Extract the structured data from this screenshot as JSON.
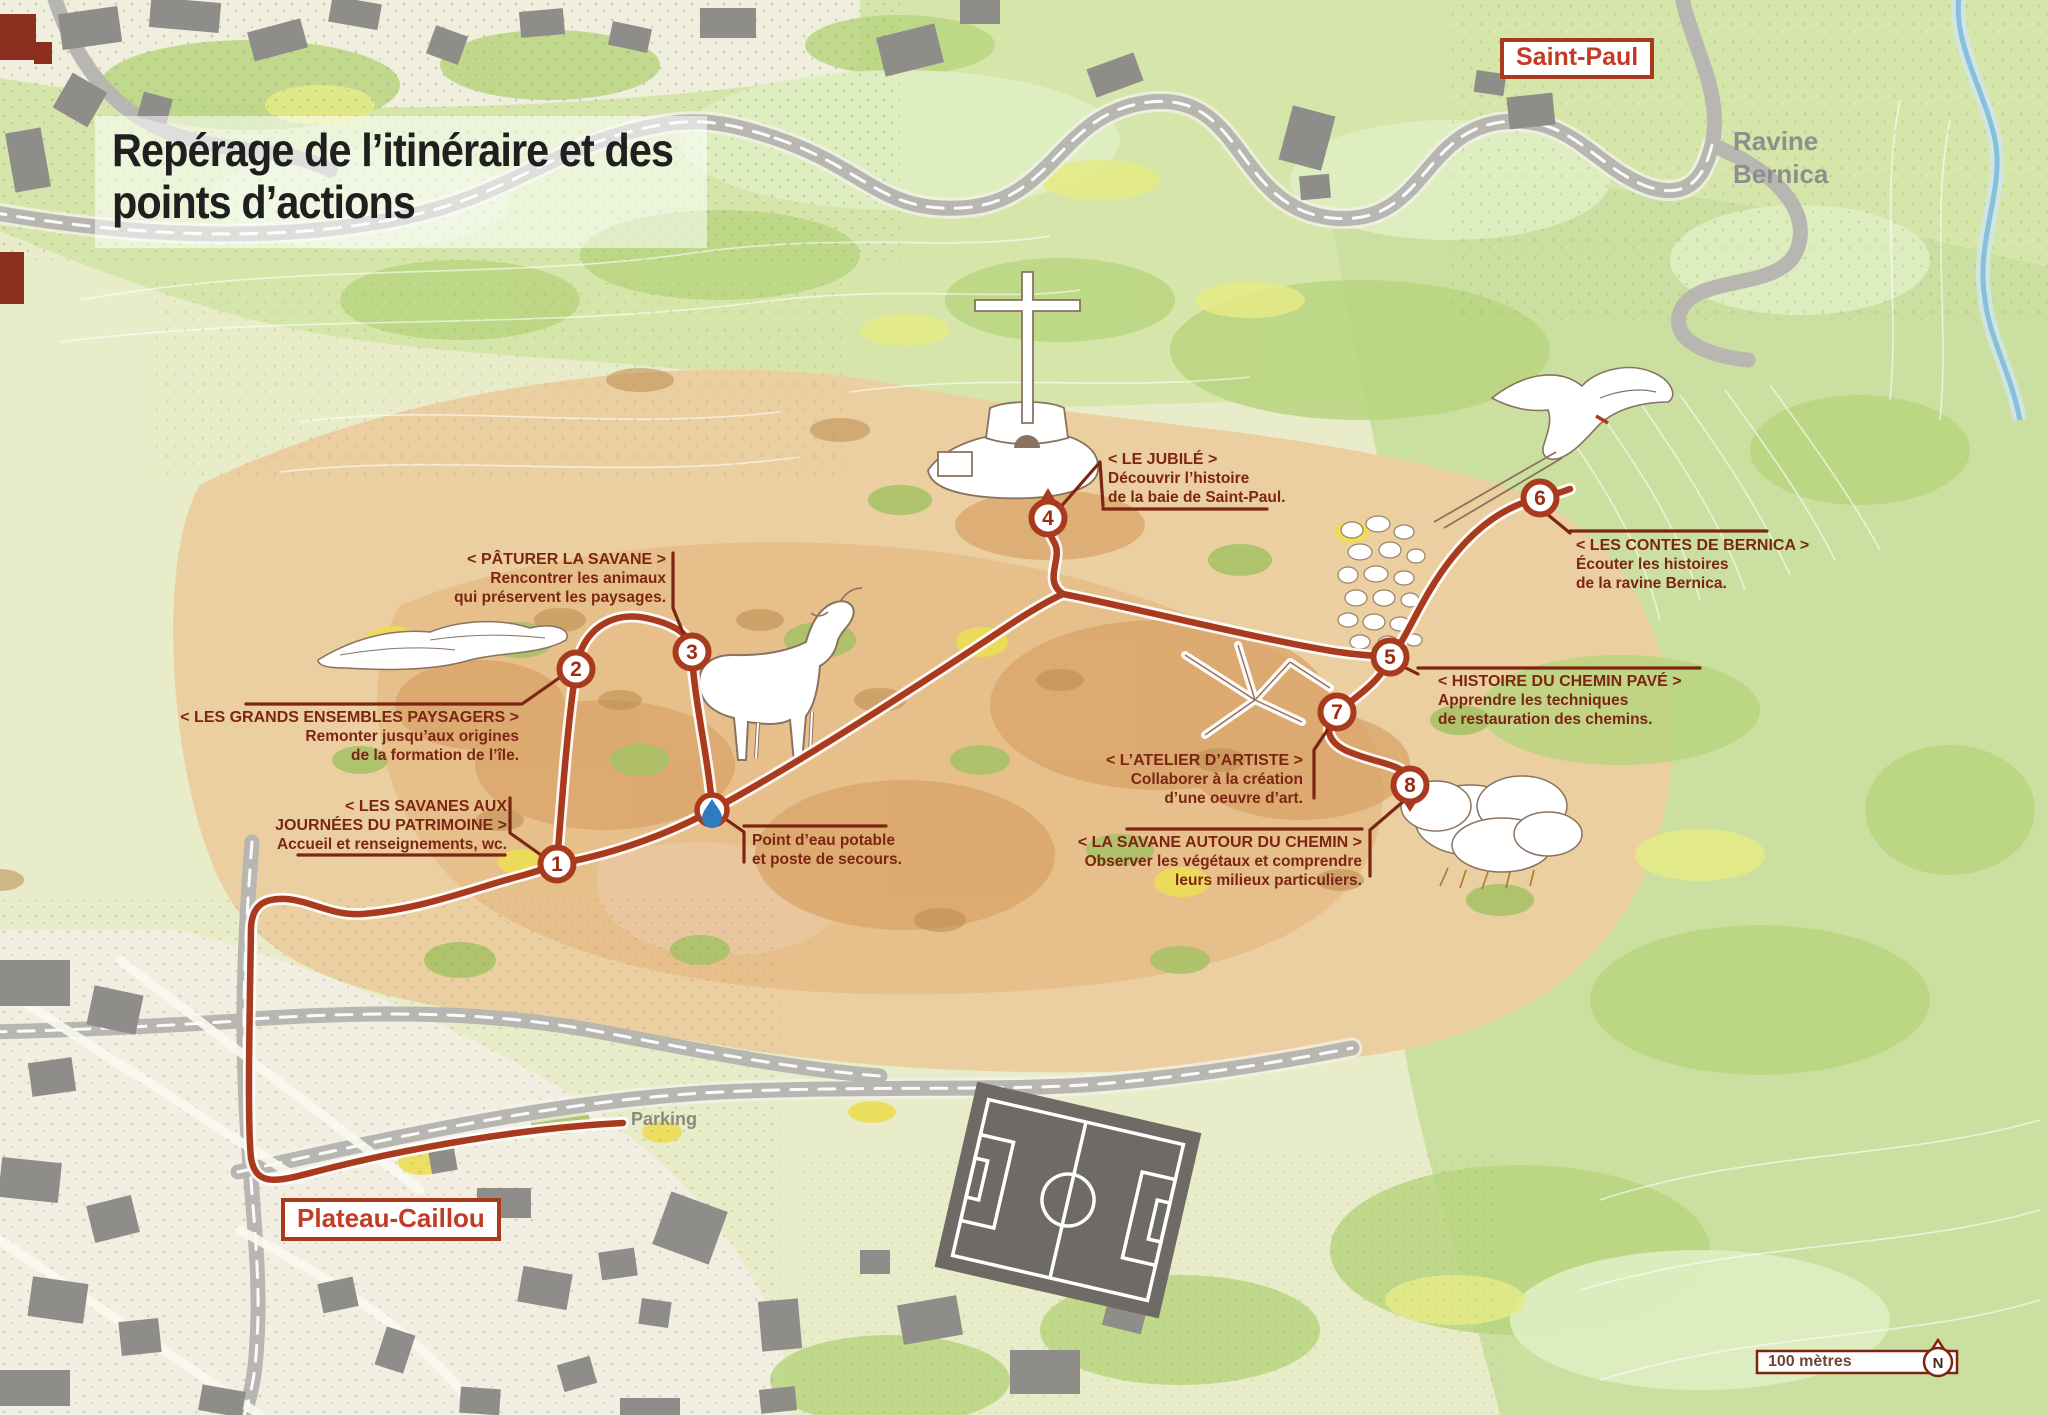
{
  "title": {
    "line1": "Repérage de l’itinéraire et des",
    "line2": "points d’actions"
  },
  "places": {
    "saint_paul": "Saint-Paul",
    "plateau_caillou": "Plateau-Caillou",
    "ravine_line1": "Ravine",
    "ravine_line2": "Bernica",
    "parking": "Parking"
  },
  "scalebar": {
    "label": "100 mètres",
    "north_letter": "N"
  },
  "markers": [
    {
      "num": "1"
    },
    {
      "num": "2"
    },
    {
      "num": "3"
    },
    {
      "num": "4"
    },
    {
      "num": "5"
    },
    {
      "num": "6"
    },
    {
      "num": "7"
    },
    {
      "num": "8"
    }
  ],
  "icons": {
    "water_point": "water-drop-icon",
    "north_arrow": "north-arrow-icon"
  },
  "callouts": {
    "patrimoine": {
      "heading1": "< LES SAVANES AUX",
      "heading2": "JOURNÉES DU PATRIMOINE >",
      "body1": "Accueil et renseignements, wc."
    },
    "paysagers": {
      "heading": "< LES GRANDS ENSEMBLES PAYSAGERS >",
      "body1": "Remonter jusqu’aux origines",
      "body2": "de la formation de l’île."
    },
    "paturer": {
      "heading": "< PÂTURER LA SAVANE >",
      "body1": "Rencontrer les animaux",
      "body2": "qui préservent les paysages."
    },
    "jubile": {
      "heading": "< LE JUBILÉ >",
      "body1": "Découvrir l’histoire",
      "body2": "de la baie de Saint-Paul."
    },
    "eau": {
      "body1": "Point d’eau potable",
      "body2": "et poste de secours."
    },
    "contes": {
      "heading": "< LES CONTES DE BERNICA >",
      "body1": "Écouter les histoires",
      "body2": "de la ravine Bernica."
    },
    "chemin_pave": {
      "heading": "< HISTOIRE DU CHEMIN PAVÉ >",
      "body1": "Apprendre les techniques",
      "body2": "de restauration des chemins."
    },
    "atelier": {
      "heading": "< L’ATELIER D’ARTISTE >",
      "body1": "Collaborer à la création",
      "body2": "d’une oeuvre d’art."
    },
    "savane_chemin": {
      "heading": "< LA SAVANE AUTOUR DU CHEMIN >",
      "body1": "Observer les végétaux et comprendre",
      "body2": "leurs milieux particuliers."
    }
  },
  "colors": {
    "trail": "#a93a1e",
    "callout_text": "#7c2513",
    "place_red": "#c23b22",
    "road_gray": "#b7b6b1"
  }
}
